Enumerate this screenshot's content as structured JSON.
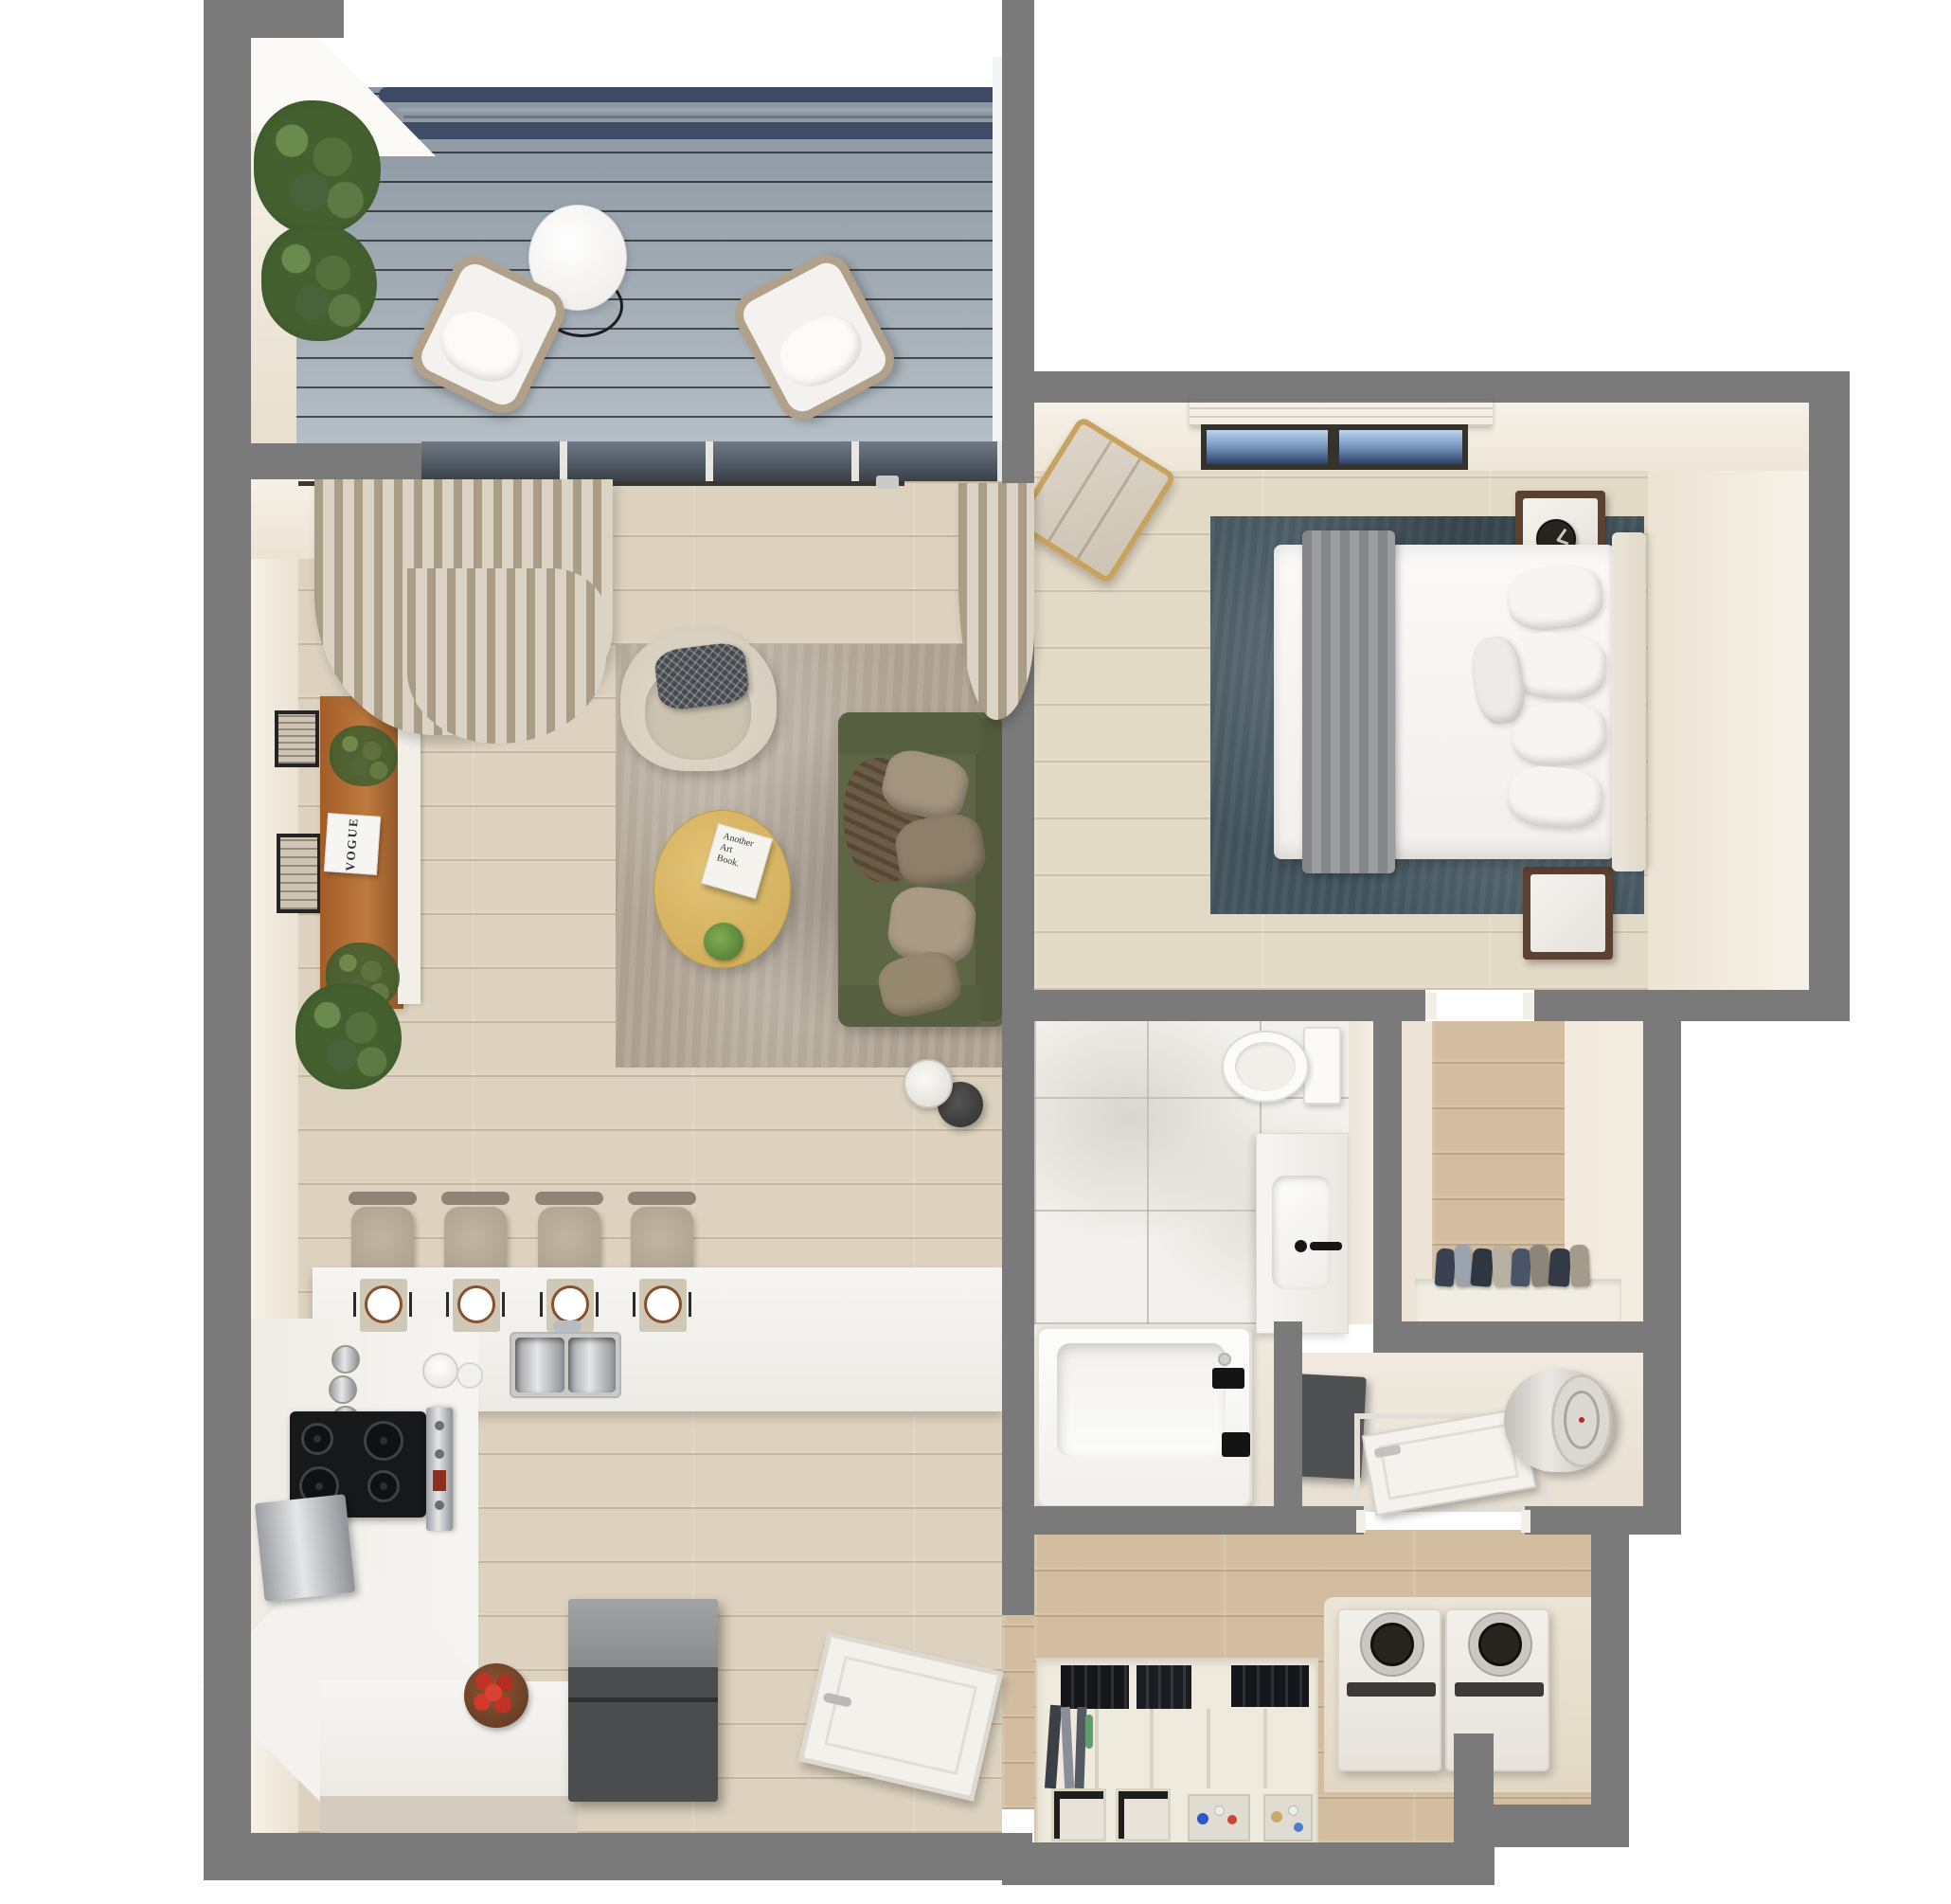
{
  "scene": {
    "type": "apartment-floorplan-3d-top-down-render",
    "background_color": "#ffffff",
    "wall_color": "#7a7a7a"
  },
  "texts": {
    "book": {
      "line1": "Another",
      "line2": "Art",
      "line3": "Book."
    },
    "magazine_title": "VOGUE"
  },
  "palette": {
    "deck": "#aab4bd",
    "deck_slat": "#3c4a66",
    "wood_living": "#ddd2bf",
    "wood_bedroom": "#e3d9c7",
    "wood_tan": "#d2bda1",
    "cream_wall_face": "#f1eadd",
    "marble": "#f2f0ec",
    "sofa_green": "#5e6645",
    "rug_living": "#b0a494",
    "rug_bedroom_teal": "#41525c",
    "coffee_table_oak": "#d9b766",
    "sideboard_wood": "#b06a33",
    "fridge_gray": "#4b4c4e",
    "bench_gold": "#c8a35f",
    "curtain_beige": "#c8bca6",
    "plant_green": "#44602f",
    "apple_red": "#c23326",
    "fixture_black": "#1c1c1c"
  },
  "rooms": [
    {
      "name": "balcony",
      "items": [
        "composite deck",
        "privacy slat railing",
        "2 potted shrubs",
        "round bistro table",
        "2 rope lounge chairs"
      ]
    },
    {
      "name": "living-room",
      "items": [
        "curtain rod",
        "sheer curtains",
        "sliding glass door",
        "2 framed art prints",
        "wood sideboard",
        "magazine",
        "floor plant",
        "accent armchair with checkered pillow",
        "distressed area rug",
        "green 3-seat sofa",
        "4 throw pillows",
        "brown throw",
        "oval oak coffee table",
        "art book",
        "small plant",
        "side table",
        "table lamp"
      ]
    },
    {
      "name": "kitchen",
      "items": [
        "breakfast bar",
        "4 bar stools",
        "4 place settings",
        "double stainless sink",
        "L-shaped counter",
        "3 spice jars",
        "black cooktop",
        "stainless oven",
        "metal panel",
        "dark refrigerator",
        "bowl of red apples",
        "open entry door"
      ]
    },
    {
      "name": "bedroom",
      "items": [
        "window with roller shade",
        "gold valet bench",
        "teal area rug",
        "bed with white duvet",
        "gray throw drape",
        "5 pillows",
        "upholstered headboard",
        "2 wood nightstands with marble tops",
        "black alarm clock"
      ]
    },
    {
      "name": "bathroom",
      "items": [
        "marble tile floor",
        "toilet",
        "white vanity with basin",
        "black faucet",
        "bathtub with black fixtures"
      ]
    },
    {
      "name": "walk-in-closet",
      "items": [
        "wood floor",
        "row of hanging clothes",
        "white shelf"
      ]
    },
    {
      "name": "utility-closet",
      "items": [
        "dark cabinet",
        "open white door",
        "water heater cylinder"
      ]
    },
    {
      "name": "laundry-room",
      "items": [
        "top-load washer",
        "top-load dryer",
        "beige appliance platform",
        "storage shelving",
        "black file boxes",
        "2 storage cubes",
        "2 bins with detergent bottles"
      ]
    }
  ]
}
